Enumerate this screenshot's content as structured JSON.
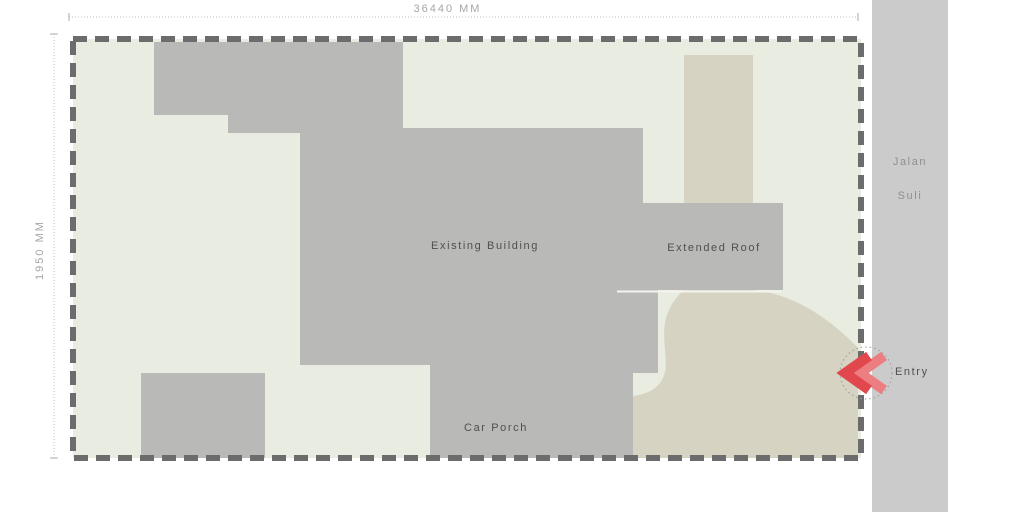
{
  "site": {
    "width_label": "36440 MM",
    "height_label": "1950 MM"
  },
  "labels": {
    "existing_building": "Existing Building",
    "extended_roof": "Extended Roof",
    "car_porch": "Car Porch",
    "entry": "Entry"
  },
  "road": {
    "line1": "Jalan",
    "line2": "Suli"
  },
  "colors": {
    "site_ground": "#e9ece1",
    "building": "#b9bab7",
    "driveway": "#d7d3c3",
    "road": "#cbcbcb",
    "boundary": "#6c6c6c",
    "dimension": "#c2c2c2",
    "entry_red": "#e0484e",
    "entry_red_light": "#ec7d81",
    "entry_circle": "#9a9a9a"
  }
}
